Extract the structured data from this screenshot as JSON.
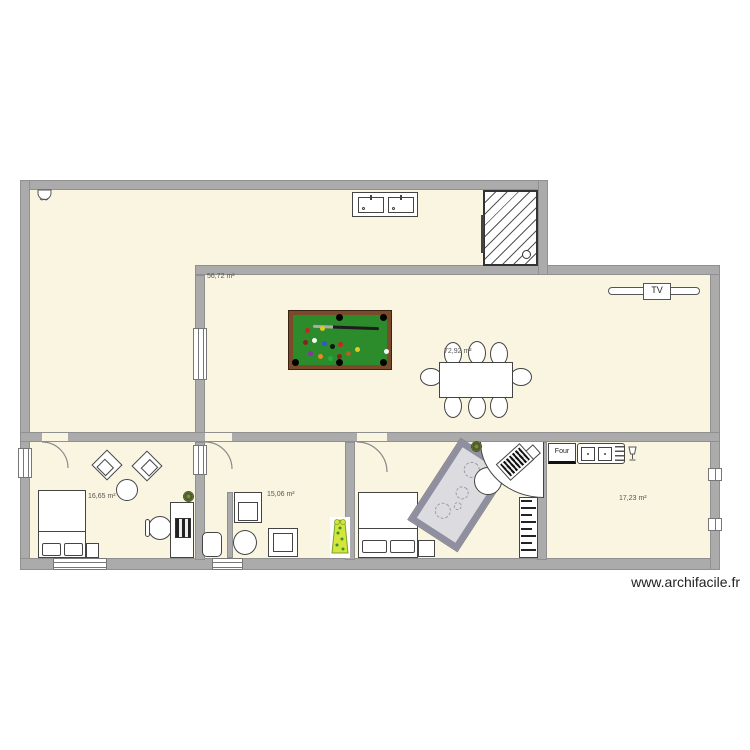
{
  "watermark": "www.archifacile.fr",
  "rooms": [
    {
      "name": "grande piece haut",
      "area": "56,72 m²"
    },
    {
      "name": "sejour",
      "area": "72,92 m²"
    },
    {
      "name": "chambre gauche",
      "area": "16,65 m²"
    },
    {
      "name": "piece milieu",
      "area": "15,06 m²"
    },
    {
      "name": "chambre milieu",
      "area": "18,32 m²"
    },
    {
      "name": "cuisine",
      "area": "17,23 m²"
    }
  ],
  "fixtures": {
    "tv_label": "TV",
    "oven_label": "Four"
  },
  "colors": {
    "floor": "#FAF5E0",
    "wall": "#ABABAB",
    "billiard_felt": "#2C8C2C",
    "billiard_frame": "#7B4A2B",
    "rug_border": "#8F8FA0",
    "plant_yellow": "#D4E53C",
    "label_text": "#555555"
  }
}
